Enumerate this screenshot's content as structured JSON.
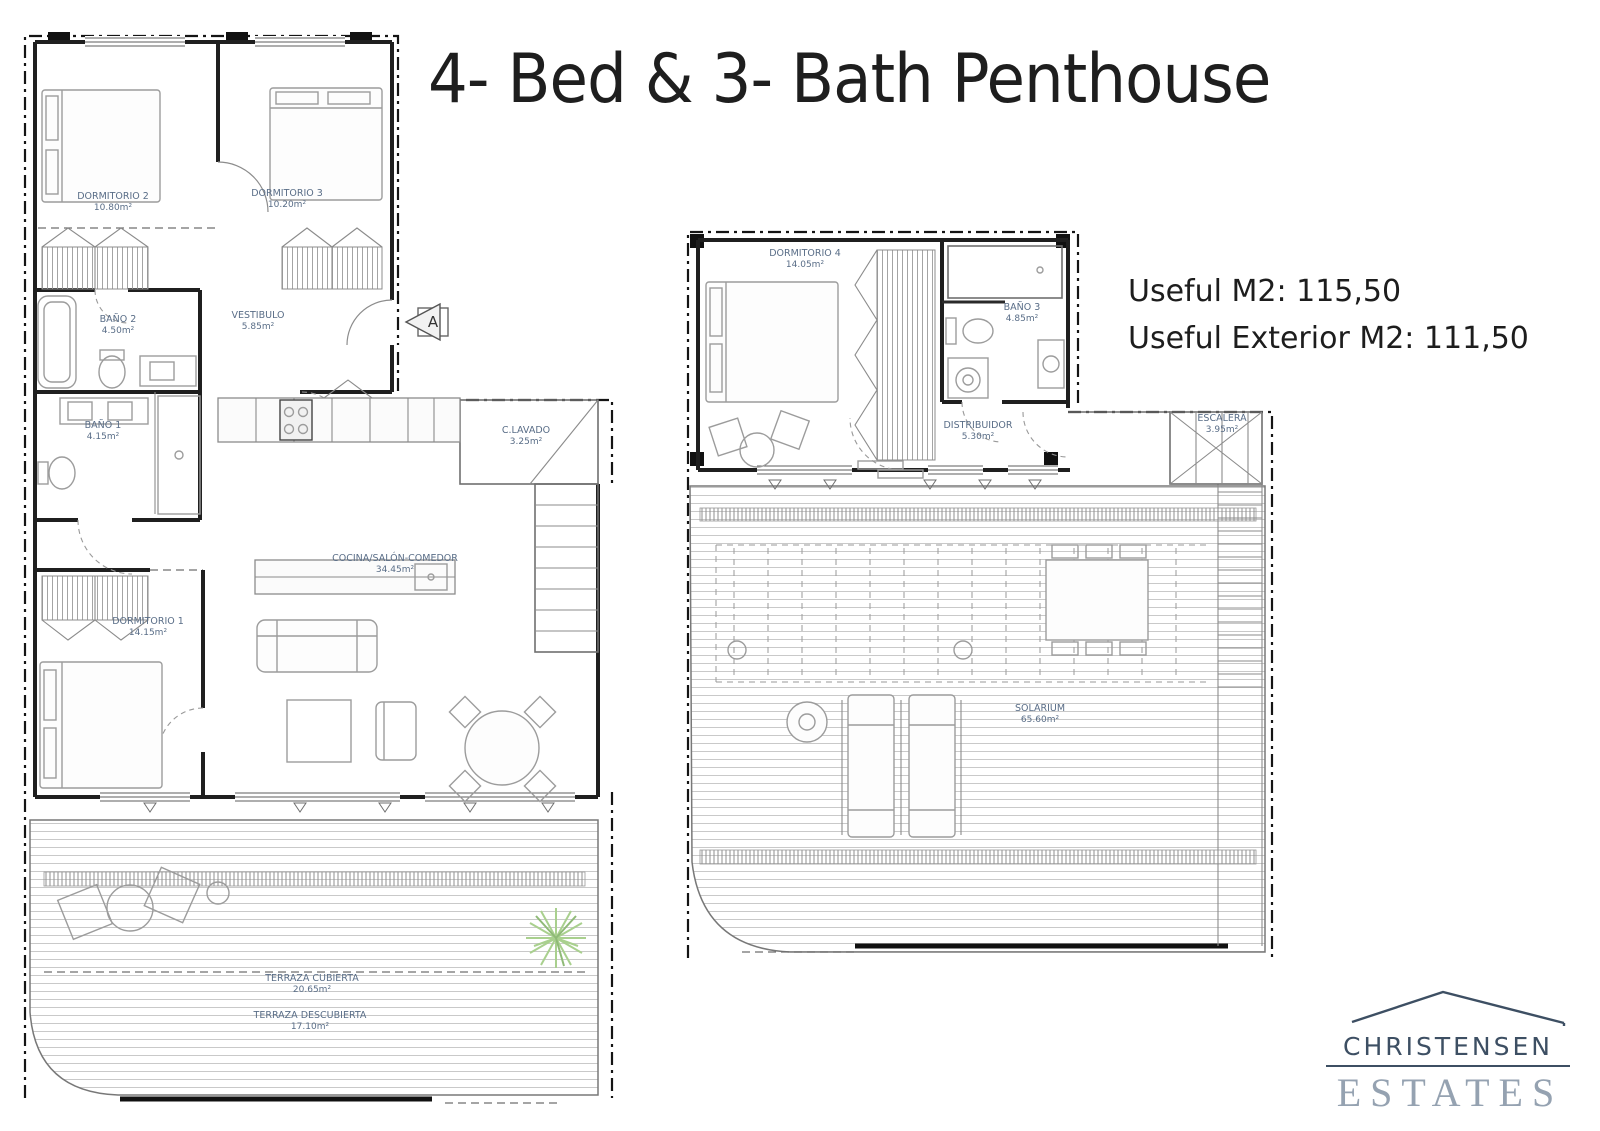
{
  "title": "4- Bed & 3- Bath Penthouse",
  "info": {
    "useful_m2": "Useful M2: 115,50",
    "useful_exterior_m2": "Useful Exterior M2: 111,50"
  },
  "section_marker": "A",
  "plans": {
    "main": {
      "rooms": [
        {
          "name": "DORMITORIO 2",
          "area": "10.80m²"
        },
        {
          "name": "DORMITORIO 3",
          "area": "10.20m²"
        },
        {
          "name": "BAÑO 2",
          "area": "4.50m²"
        },
        {
          "name": "VESTIBULO",
          "area": "5.85m²"
        },
        {
          "name": "BAÑO 1",
          "area": "4.15m²"
        },
        {
          "name": "C.LAVADO",
          "area": "3.25m²"
        },
        {
          "name": "COCINA/SALÓN-COMEDOR",
          "area": "34.45m²"
        },
        {
          "name": "DORMITORIO 1",
          "area": "14.15m²"
        },
        {
          "name": "TERRAZA CUBIERTA",
          "area": "20.65m²"
        },
        {
          "name": "TERRAZA DESCUBIERTA",
          "area": "17.10m²"
        }
      ]
    },
    "upper": {
      "rooms": [
        {
          "name": "DORMITORIO 4",
          "area": "14.05m²"
        },
        {
          "name": "BAÑO 3",
          "area": "4.85m²"
        },
        {
          "name": "DISTRIBUIDOR",
          "area": "5.30m²"
        },
        {
          "name": "ESCALERA",
          "area": "3.95m²"
        },
        {
          "name": "SOLARIUM",
          "area": "65.60m²"
        }
      ]
    }
  },
  "logo": {
    "line1": "CHRISTENSEN",
    "line2": "ESTATES"
  },
  "colors": {
    "label_text": "#596d87",
    "plant_green": "#a9d08e",
    "logo_dark": "#3d4f63",
    "logo_light": "#95a2b1",
    "walls": "#1f1f1f"
  }
}
